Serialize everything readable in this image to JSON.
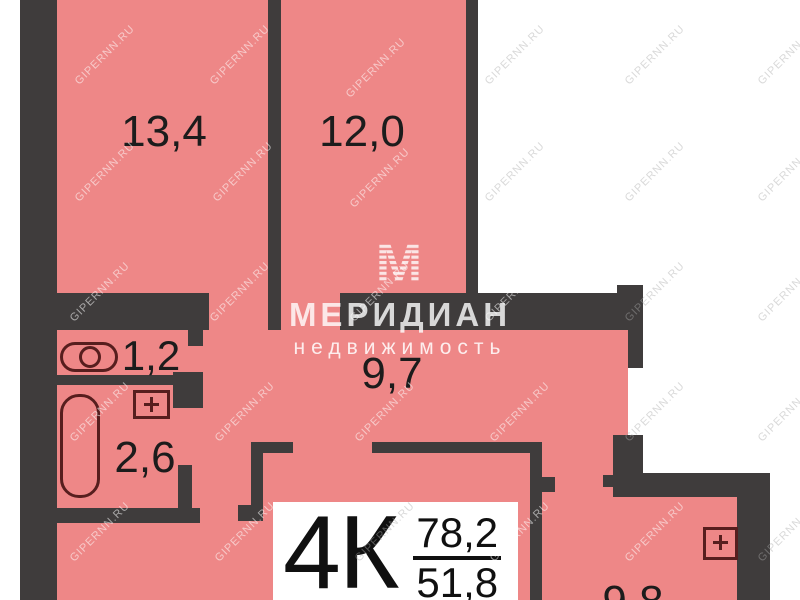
{
  "plan_title": "apartment-floor-plan",
  "colors": {
    "floor_fill": "#ee8787",
    "wall": "#3f3c3c",
    "fixture_outline": "#571e1e",
    "label_text": "#1c1c1c",
    "background": "#ffffff",
    "logo_text": "rgba(255,255,255,0.8)"
  },
  "rooms": [
    {
      "name": "room-top-left",
      "area": "13,4"
    },
    {
      "name": "room-top-right",
      "area": "12,0"
    },
    {
      "name": "wc",
      "area": "1,2"
    },
    {
      "name": "hallway",
      "area": "9,7"
    },
    {
      "name": "bathroom",
      "area": "2,6"
    },
    {
      "name": "room-bottom-right",
      "area": "9,8"
    }
  ],
  "badge": {
    "type": "4К",
    "total_area": "78,2",
    "living_area": "51,8"
  },
  "logo": {
    "monogram": "М",
    "title": "МЕРИДИАН",
    "subtitle": "недвижимость"
  },
  "watermark": {
    "text": "GIPERNN.RU",
    "positions": [
      [
        105,
        55,
        "w"
      ],
      [
        240,
        55,
        "w"
      ],
      [
        376,
        68,
        "w"
      ],
      [
        515,
        55,
        "g"
      ],
      [
        655,
        55,
        "g"
      ],
      [
        788,
        55,
        "g"
      ],
      [
        105,
        172,
        "w"
      ],
      [
        243,
        172,
        "w"
      ],
      [
        380,
        178,
        "w"
      ],
      [
        515,
        172,
        "g"
      ],
      [
        655,
        172,
        "g"
      ],
      [
        788,
        172,
        "g"
      ],
      [
        100,
        292,
        "w"
      ],
      [
        240,
        292,
        "w"
      ],
      [
        380,
        292,
        "w"
      ],
      [
        515,
        292,
        "w"
      ],
      [
        655,
        292,
        "g"
      ],
      [
        788,
        292,
        "g"
      ],
      [
        100,
        412,
        "w"
      ],
      [
        245,
        412,
        "w"
      ],
      [
        385,
        412,
        "w"
      ],
      [
        520,
        412,
        "w"
      ],
      [
        655,
        412,
        "g"
      ],
      [
        788,
        412,
        "g"
      ],
      [
        100,
        532,
        "w"
      ],
      [
        245,
        532,
        "w"
      ],
      [
        385,
        532,
        "g"
      ],
      [
        520,
        532,
        "w"
      ],
      [
        655,
        532,
        "w"
      ],
      [
        788,
        532,
        "g"
      ]
    ]
  }
}
